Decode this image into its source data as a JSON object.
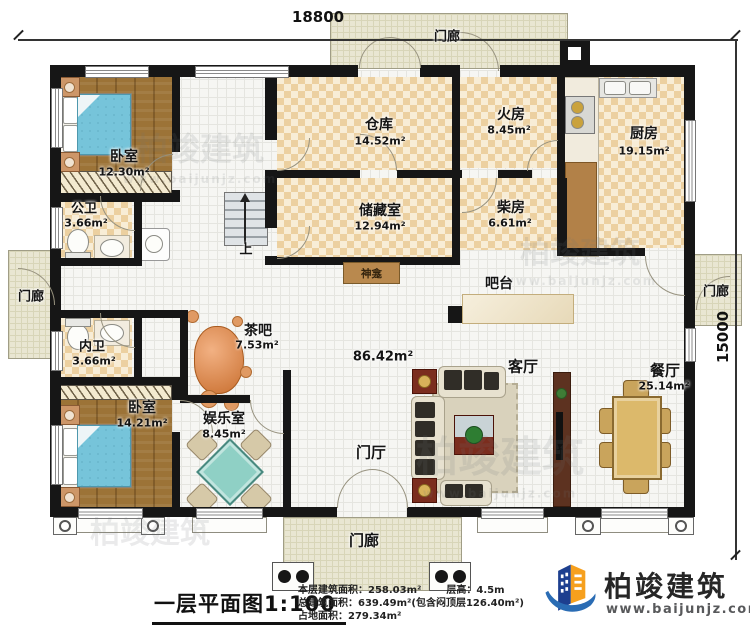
{
  "dimensions": {
    "width_label": "18800",
    "height_label": "15000"
  },
  "rooms": [
    {
      "label": "卧室",
      "area": "12.30m²"
    },
    {
      "label": "公卫",
      "area": "3.66m²"
    },
    {
      "label": "内卫",
      "area": "3.66m²"
    },
    {
      "label": "卧室",
      "area": "14.21m²"
    },
    {
      "label": "娱乐室",
      "area": "8.45m²"
    },
    {
      "label": "茶吧",
      "area": "7.53m²"
    },
    {
      "label": "仓库",
      "area": "14.52m²"
    },
    {
      "label": "储藏室",
      "area": "12.94m²"
    },
    {
      "label": "火房",
      "area": "8.45m²"
    },
    {
      "label": "柴房",
      "area": "6.61m²"
    },
    {
      "label": "厨房",
      "area": "19.15m²"
    },
    {
      "label": "餐厅",
      "area": "25.14m²"
    },
    {
      "label": "客厅",
      "area": "86.42m²"
    }
  ],
  "annotations": {
    "foyer": "门厅",
    "porch": "门廊",
    "bar_counter": "吧台",
    "shrine": "神龛",
    "stairs_up": "上"
  },
  "legend": {
    "plan_title": "一层平面图1:100",
    "floor_area": "本层建筑面积：258.03m²",
    "storey_height": "层高：4.5m",
    "total_area": "总建筑面积：639.49m²(包含闷顶层126.40m²)",
    "footprint_area": "占地面积：279.34m²"
  },
  "logo": {
    "company": "柏竣建筑",
    "website": "www.baijunjz.com"
  },
  "watermark": {
    "text": "柏竣建筑",
    "site": "www.baijunjz.com"
  },
  "colors": {
    "wall": "#161616",
    "checker": "#ecd0a0",
    "wood": "#9c7337",
    "porch": "#e9e6d2",
    "bed": "#76c4da",
    "logo_blue": "#2a6cb4",
    "logo_orange": "#f6a01e"
  }
}
